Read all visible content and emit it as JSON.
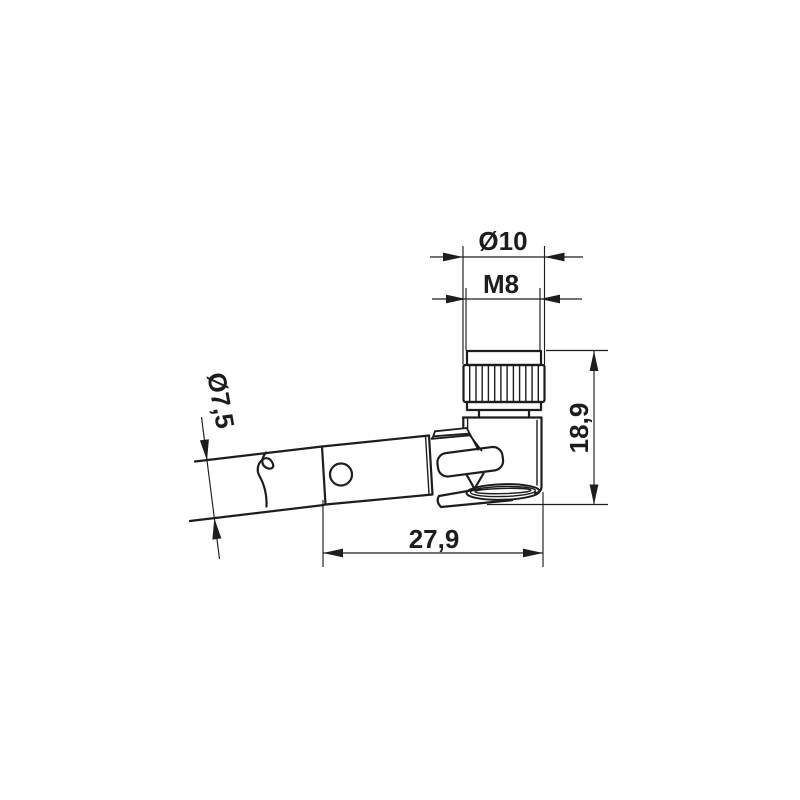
{
  "drawing": {
    "title": "M8 right-angle female connector — dimensional drawing",
    "colors": {
      "line": "#1d1d1b",
      "background": "#ffffff"
    },
    "dimensions": {
      "nut_outer_diameter": {
        "label": "Ø10"
      },
      "thread": {
        "label": "M8"
      },
      "height": {
        "label": "18,9"
      },
      "length": {
        "label": "27,9"
      },
      "cable_diameter": {
        "label": "Ø7,5"
      }
    }
  }
}
